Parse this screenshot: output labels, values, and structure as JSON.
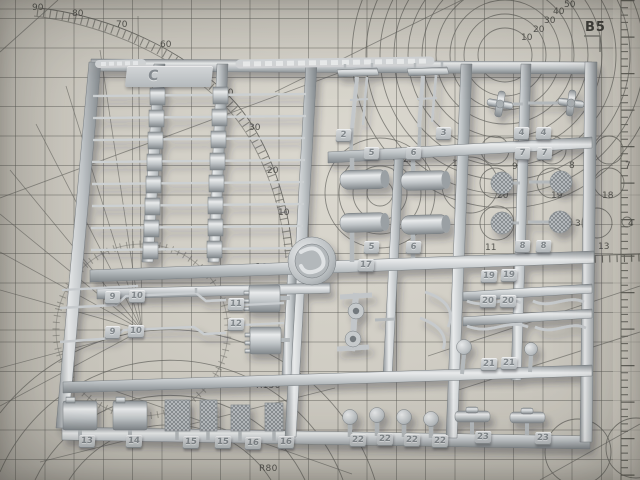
{
  "scene": {
    "description": "Photograph of a light-gray plastic model-kit sprue (runner C) with numbered part tags, lying on a printed cutting mat",
    "mat_base_color": "#d0cdc4",
    "mat_line_color": "#5d5d58",
    "plastic_color": "#c3c7ca"
  },
  "mat": {
    "label_b5": "B5",
    "ruler_label_1000": "1000",
    "protractor_labels": [
      {
        "t": "90",
        "x": 32,
        "y": 3
      },
      {
        "t": "80",
        "x": 72,
        "y": 9
      },
      {
        "t": "70",
        "x": 116,
        "y": 20
      },
      {
        "t": "60",
        "x": 160,
        "y": 40
      },
      {
        "t": "40",
        "x": 222,
        "y": 88
      },
      {
        "t": "30",
        "x": 249,
        "y": 123
      },
      {
        "t": "20",
        "x": 267,
        "y": 166
      },
      {
        "t": "10",
        "x": 278,
        "y": 208
      }
    ],
    "circle_scale_labels": [
      {
        "t": "10",
        "x": 521,
        "y": 33
      },
      {
        "t": "20",
        "x": 533,
        "y": 25
      },
      {
        "t": "30",
        "x": 544,
        "y": 16
      },
      {
        "t": "40",
        "x": 553,
        "y": 7
      },
      {
        "t": "50",
        "x": 564,
        "y": 0
      }
    ],
    "center_circle_labels": [
      {
        "t": "25",
        "x": 403,
        "y": 155
      },
      {
        "t": "15",
        "x": 392,
        "y": 164
      },
      {
        "t": "5",
        "x": 382,
        "y": 175
      },
      {
        "t": "10",
        "x": 452,
        "y": 159
      }
    ],
    "template_circle_labels": [
      {
        "t": "9",
        "x": 512,
        "y": 162
      },
      {
        "t": "8",
        "x": 569,
        "y": 161
      },
      {
        "t": "7",
        "x": 625,
        "y": 161
      },
      {
        "t": "20",
        "x": 497,
        "y": 191
      },
      {
        "t": "19",
        "x": 551,
        "y": 191
      },
      {
        "t": "18",
        "x": 602,
        "y": 191
      },
      {
        "t": "11",
        "x": 485,
        "y": 243
      },
      {
        "t": "3",
        "x": 575,
        "y": 219
      },
      {
        "t": "13",
        "x": 598,
        "y": 242
      },
      {
        "t": "4",
        "x": 628,
        "y": 219
      }
    ],
    "radius_labels": [
      {
        "t": "R40",
        "x": 228,
        "y": 434
      },
      {
        "t": "R80",
        "x": 259,
        "y": 464
      },
      {
        "t": "R150",
        "x": 256,
        "y": 381
      }
    ]
  },
  "sprue": {
    "gate_letter": "C",
    "part_tags": [
      {
        "t": "2",
        "x": 336,
        "y": 129
      },
      {
        "t": "3",
        "x": 436,
        "y": 127
      },
      {
        "t": "5",
        "x": 364,
        "y": 147
      },
      {
        "t": "6",
        "x": 406,
        "y": 147
      },
      {
        "t": "5",
        "x": 364,
        "y": 241
      },
      {
        "t": "6",
        "x": 406,
        "y": 241
      },
      {
        "t": "17",
        "x": 358,
        "y": 259
      },
      {
        "t": "4",
        "x": 514,
        "y": 127
      },
      {
        "t": "4",
        "x": 536,
        "y": 127
      },
      {
        "t": "7",
        "x": 515,
        "y": 147
      },
      {
        "t": "7",
        "x": 537,
        "y": 147
      },
      {
        "t": "8",
        "x": 515,
        "y": 240
      },
      {
        "t": "8",
        "x": 536,
        "y": 240
      },
      {
        "t": "19",
        "x": 481,
        "y": 270
      },
      {
        "t": "19",
        "x": 501,
        "y": 269
      },
      {
        "t": "20",
        "x": 480,
        "y": 295
      },
      {
        "t": "20",
        "x": 500,
        "y": 295
      },
      {
        "t": "21",
        "x": 481,
        "y": 358
      },
      {
        "t": "21",
        "x": 501,
        "y": 357
      },
      {
        "t": "9",
        "x": 105,
        "y": 291
      },
      {
        "t": "10",
        "x": 129,
        "y": 290
      },
      {
        "t": "9",
        "x": 105,
        "y": 326
      },
      {
        "t": "10",
        "x": 128,
        "y": 325
      },
      {
        "t": "11",
        "x": 228,
        "y": 298
      },
      {
        "t": "12",
        "x": 228,
        "y": 318
      },
      {
        "t": "13",
        "x": 79,
        "y": 435
      },
      {
        "t": "14",
        "x": 126,
        "y": 435
      },
      {
        "t": "15",
        "x": 183,
        "y": 436
      },
      {
        "t": "15",
        "x": 215,
        "y": 436
      },
      {
        "t": "16",
        "x": 245,
        "y": 437
      },
      {
        "t": "16",
        "x": 278,
        "y": 436
      },
      {
        "t": "22",
        "x": 350,
        "y": 434
      },
      {
        "t": "22",
        "x": 377,
        "y": 433
      },
      {
        "t": "22",
        "x": 404,
        "y": 434
      },
      {
        "t": "22",
        "x": 432,
        "y": 435
      },
      {
        "t": "23",
        "x": 475,
        "y": 431
      },
      {
        "t": "23",
        "x": 535,
        "y": 432
      }
    ]
  }
}
